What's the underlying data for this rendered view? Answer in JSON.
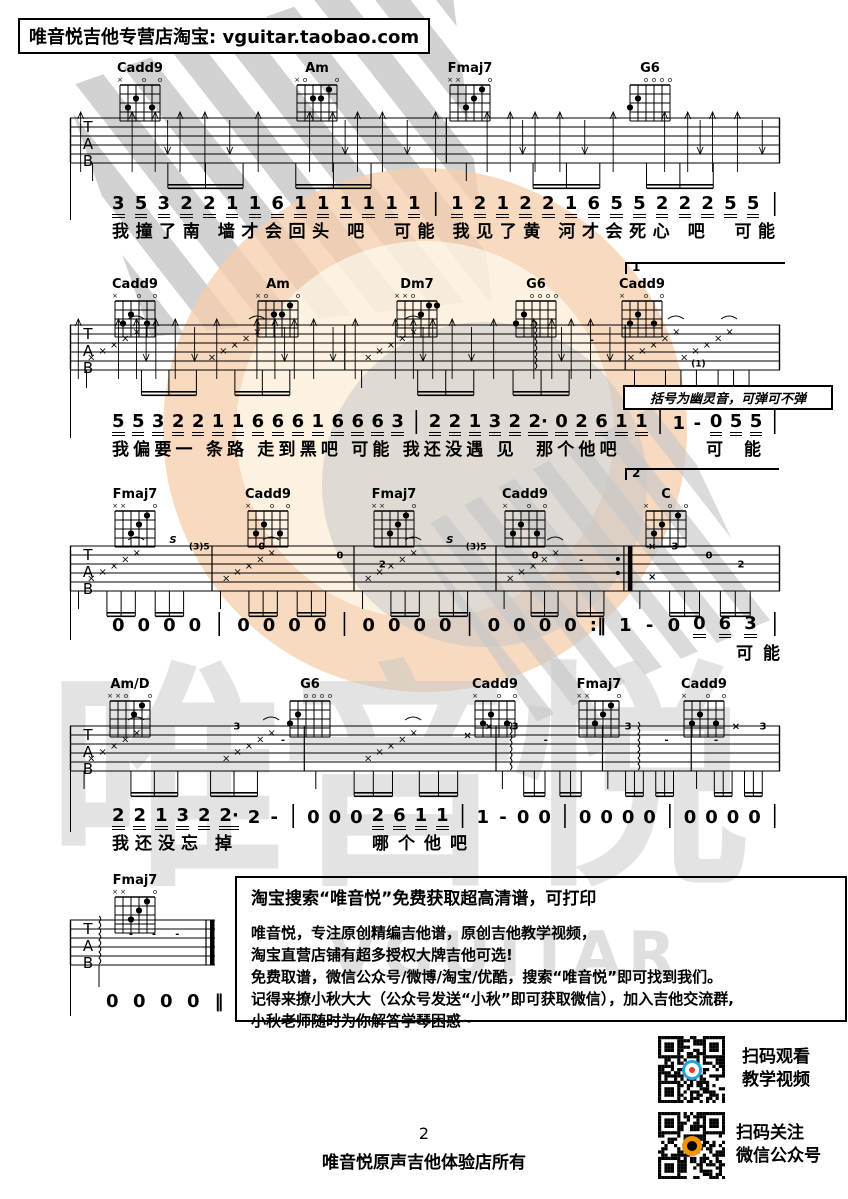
{
  "header": {
    "shop": "唯音悦吉他专营店淘宝: vguitar.taobao.com"
  },
  "watermarks": {
    "brand_cn": "唯音悦",
    "brand_en": "VGUITAR"
  },
  "colors": {
    "ink": "#000000",
    "watermark_gray": "#c8c8c8",
    "watermark_peach": "#f6ceac",
    "watermark_cream": "#fdf0dd"
  },
  "systems": [
    {
      "chords": [
        {
          "name": "Cadd9",
          "frets": "x32030"
        },
        {
          "name": "Am",
          "frets": "x02210"
        },
        {
          "name": "Fmaj7",
          "frets": "xx3210"
        },
        {
          "name": "G6",
          "frets": "320000"
        }
      ],
      "numbers": "3 5 3 2 2 1 1 6 1 1 1 1 1 1 | 1 2 1 2 2 1 6 5 5 2 2 2 5 5 |",
      "underline": "digits",
      "lyrics": [
        "我撞了南 墙才会回头 吧  可能 我见了黄 河才会死心 吧  可能"
      ]
    },
    {
      "volta_start": "1",
      "volta_end": "2",
      "note": "括号为幽灵音，可弹可不弹",
      "ghost": "(1)",
      "chords": [
        {
          "name": "Cadd9",
          "frets": "x32030"
        },
        {
          "name": "Am",
          "frets": "x02210"
        },
        {
          "name": "Dm7",
          "frets": "xx0211"
        },
        {
          "name": "G6",
          "frets": "320000"
        },
        {
          "name": "Cadd9",
          "frets": "x32030"
        }
      ],
      "numbers": "5 5 3 2 2 1 1 6 6 6 1 6 6 6 3 | 2 2 1 3 2 2· 0 2 6 1 1 | 1 - 0 5 5 |",
      "underline": [
        0,
        1,
        2,
        3,
        4,
        5,
        6,
        7,
        8,
        9,
        10,
        11,
        12,
        13,
        14,
        16,
        17,
        18,
        19,
        20,
        21,
        22,
        23,
        24,
        25,
        26,
        30,
        31,
        32
      ],
      "lyrics": [
        "我偏要一 条路 走到黑吧 可能 我还没遇 见  那个他吧",
        "可 能"
      ]
    },
    {
      "chords": [
        {
          "name": "Fmaj7",
          "frets": "xx3210"
        },
        {
          "name": "Cadd9",
          "frets": "x32030"
        },
        {
          "name": "Fmaj7",
          "frets": "xx3210"
        },
        {
          "name": "Cadd9",
          "frets": "x32030"
        },
        {
          "name": "C",
          "frets": "x32010"
        }
      ],
      "numbers": "0 0 0 0 | 0 0 0 0 | 0 0 0 0 | 0 0 0 0 :‖ 1 - 0 0 6 3 |",
      "underline": [
        23,
        24,
        25
      ],
      "lyrics": [
        "可能"
      ],
      "tab_labels": [
        "S",
        "(3)5",
        "0",
        "0",
        "2",
        "-",
        "S",
        "(3)5",
        "0",
        "3",
        "0",
        "2"
      ]
    },
    {
      "chords": [
        {
          "name": "Am/D",
          "frets": "xx0210"
        },
        {
          "name": "G6",
          "frets": "320000"
        },
        {
          "name": "Cadd9",
          "frets": "x32030"
        },
        {
          "name": "Fmaj7",
          "frets": "xx3210"
        },
        {
          "name": "Cadd9",
          "frets": "x32030"
        }
      ],
      "numbers": "2 2 1 3 2 2· 2 - | 0 0 0 2 6 1 1 | 1 - 0 0 | 0 0 0 0 | 0 0 0 0 |",
      "underline": [
        0,
        1,
        2,
        3,
        4,
        5,
        12,
        13,
        14,
        15
      ],
      "lyrics": [
        "我还没忘 掉",
        "哪个他吧"
      ],
      "tab_labels": [
        "3",
        "-",
        "3",
        "-",
        "3",
        "-",
        "3"
      ]
    },
    {
      "chords": [
        {
          "name": "Fmaj7",
          "frets": "xx3210"
        }
      ],
      "numbers": "0 0 0 0 ‖",
      "underline": "none",
      "lyrics": [],
      "tab_labels": [
        "-",
        "-",
        "-"
      ]
    }
  ],
  "promo": {
    "title": "淘宝搜索“唯音悦”免费获取超高清谱，可打印",
    "lines": [
      "唯音悦，专注原创精编吉他谱，原创吉他教学视频，",
      "淘宝直营店铺有超多授权大牌吉他可选!",
      "免费取谱，微信公众号/微博/淘宝/优酷，搜索“唯音悦”即可找到我们。",
      "记得来撩小秋大大（公众号发送“小秋”即可获取微信），加入吉他交流群,",
      "小秋老师随时为你解答学琴困惑~"
    ]
  },
  "qr_blocks": [
    {
      "caption_line1": "扫码观看",
      "caption_line2": "教学视频"
    },
    {
      "caption_line1": "扫码关注",
      "caption_line2": "微信公众号"
    }
  ],
  "footer": {
    "page_number": "2",
    "copyright": "唯音悦原声吉他体验店所有"
  }
}
